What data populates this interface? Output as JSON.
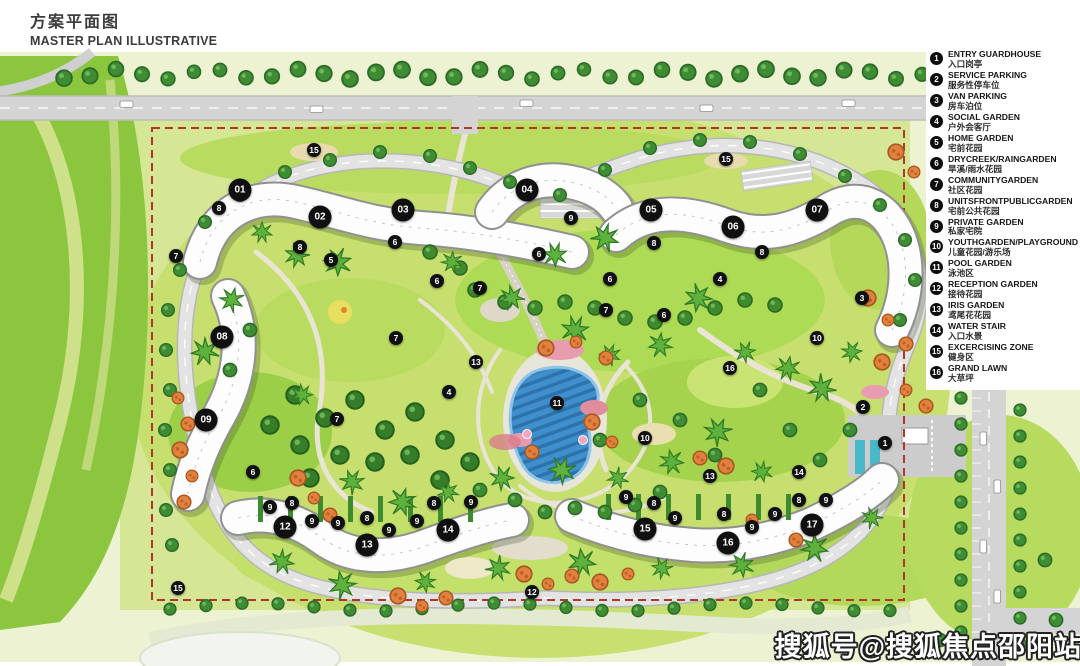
{
  "title": {
    "cn": "方案平面图",
    "en": "MASTER PLAN ILLUSTRATIVE"
  },
  "watermark": {
    "text": "搜狐号@搜狐焦点邵阳站"
  },
  "colors": {
    "boundary_red": "#b0362b",
    "marker_black": "#101010",
    "pool_blue": "#3f8fcc",
    "lawn_green": "#c8e070",
    "dark_tree_green": "#3e8c34",
    "orange_tree": "#e0813f",
    "road_gray": "#d4d4d4"
  },
  "legend": {
    "items": [
      {
        "num": "1",
        "en": "ENTRY GUARDHOUSE",
        "cn": "入口岗亭"
      },
      {
        "num": "2",
        "en": "SERVICE PARKING",
        "cn": "服务性停车位"
      },
      {
        "num": "3",
        "en": "VAN PARKING",
        "cn": "房车泊位"
      },
      {
        "num": "4",
        "en": "SOCIAL GARDEN",
        "cn": "户外会客厅"
      },
      {
        "num": "5",
        "en": "HOME GARDEN",
        "cn": "宅前花园"
      },
      {
        "num": "6",
        "en": "DRYCREEK/RAINGARDEN",
        "cn": "旱溪/雨水花园"
      },
      {
        "num": "7",
        "en": "COMMUNITYGARDEN",
        "cn": "社区花园"
      },
      {
        "num": "8",
        "en": "UNITSFRONTPUBLICGARDEN",
        "cn": "宅前公共花园"
      },
      {
        "num": "9",
        "en": "PRIVATE GARDEN",
        "cn": "私家宅院"
      },
      {
        "num": "10",
        "en": "YOUTHGARDEN/PLAYGROUND",
        "cn": "儿童花园/游乐场"
      },
      {
        "num": "11",
        "en": "POOL GARDEN",
        "cn": "泳池区"
      },
      {
        "num": "12",
        "en": "RECEPTION GARDEN",
        "cn": "接待花园"
      },
      {
        "num": "13",
        "en": "IRIS GARDEN",
        "cn": "鸢尾花花园"
      },
      {
        "num": "14",
        "en": "WATER STAIR",
        "cn": "入口水景"
      },
      {
        "num": "15",
        "en": "EXCERCISING ZONE",
        "cn": "健身区"
      },
      {
        "num": "16",
        "en": "GRAND LAWN",
        "cn": "大草坪"
      }
    ]
  },
  "buildings": [
    {
      "label": "01",
      "x": 240,
      "y": 190
    },
    {
      "label": "02",
      "x": 320,
      "y": 217
    },
    {
      "label": "03",
      "x": 403,
      "y": 210
    },
    {
      "label": "04",
      "x": 527,
      "y": 190
    },
    {
      "label": "05",
      "x": 651,
      "y": 210
    },
    {
      "label": "06",
      "x": 733,
      "y": 227
    },
    {
      "label": "07",
      "x": 817,
      "y": 210
    },
    {
      "label": "08",
      "x": 222,
      "y": 337
    },
    {
      "label": "09",
      "x": 206,
      "y": 420
    },
    {
      "label": "12",
      "x": 285,
      "y": 527
    },
    {
      "label": "13",
      "x": 367,
      "y": 545
    },
    {
      "label": "14",
      "x": 448,
      "y": 530
    },
    {
      "label": "15",
      "x": 645,
      "y": 529
    },
    {
      "label": "16",
      "x": 728,
      "y": 543
    },
    {
      "label": "17",
      "x": 812,
      "y": 525
    }
  ],
  "site_markers": [
    {
      "num": "15",
      "x": 314,
      "y": 150
    },
    {
      "num": "8",
      "x": 219,
      "y": 208
    },
    {
      "num": "7",
      "x": 176,
      "y": 256
    },
    {
      "num": "8",
      "x": 300,
      "y": 247
    },
    {
      "num": "5",
      "x": 331,
      "y": 260
    },
    {
      "num": "6",
      "x": 395,
      "y": 242
    },
    {
      "num": "6",
      "x": 437,
      "y": 281
    },
    {
      "num": "7",
      "x": 480,
      "y": 288
    },
    {
      "num": "15",
      "x": 726,
      "y": 159
    },
    {
      "num": "9",
      "x": 571,
      "y": 218
    },
    {
      "num": "6",
      "x": 539,
      "y": 254
    },
    {
      "num": "8",
      "x": 654,
      "y": 243
    },
    {
      "num": "8",
      "x": 762,
      "y": 252
    },
    {
      "num": "6",
      "x": 610,
      "y": 279
    },
    {
      "num": "4",
      "x": 720,
      "y": 279
    },
    {
      "num": "3",
      "x": 862,
      "y": 298
    },
    {
      "num": "7",
      "x": 606,
      "y": 310
    },
    {
      "num": "6",
      "x": 664,
      "y": 315
    },
    {
      "num": "10",
      "x": 817,
      "y": 338
    },
    {
      "num": "7",
      "x": 396,
      "y": 338
    },
    {
      "num": "13",
      "x": 476,
      "y": 362
    },
    {
      "num": "4",
      "x": 449,
      "y": 392
    },
    {
      "num": "7",
      "x": 337,
      "y": 419
    },
    {
      "num": "6",
      "x": 253,
      "y": 472
    },
    {
      "num": "11",
      "x": 557,
      "y": 403
    },
    {
      "num": "10",
      "x": 645,
      "y": 438
    },
    {
      "num": "16",
      "x": 730,
      "y": 368
    },
    {
      "num": "13",
      "x": 710,
      "y": 476
    },
    {
      "num": "14",
      "x": 799,
      "y": 472
    },
    {
      "num": "1",
      "x": 885,
      "y": 443
    },
    {
      "num": "2",
      "x": 863,
      "y": 407
    },
    {
      "num": "12",
      "x": 532,
      "y": 592
    },
    {
      "num": "15",
      "x": 178,
      "y": 588
    },
    {
      "num": "9",
      "x": 270,
      "y": 507
    },
    {
      "num": "8",
      "x": 292,
      "y": 503
    },
    {
      "num": "9",
      "x": 312,
      "y": 521
    },
    {
      "num": "9",
      "x": 338,
      "y": 523
    },
    {
      "num": "8",
      "x": 367,
      "y": 518
    },
    {
      "num": "9",
      "x": 389,
      "y": 530
    },
    {
      "num": "9",
      "x": 417,
      "y": 521
    },
    {
      "num": "8",
      "x": 434,
      "y": 503
    },
    {
      "num": "9",
      "x": 471,
      "y": 502
    },
    {
      "num": "9",
      "x": 626,
      "y": 497
    },
    {
      "num": "8",
      "x": 654,
      "y": 503
    },
    {
      "num": "9",
      "x": 675,
      "y": 518
    },
    {
      "num": "8",
      "x": 724,
      "y": 514
    },
    {
      "num": "9",
      "x": 752,
      "y": 527
    },
    {
      "num": "9",
      "x": 775,
      "y": 514
    },
    {
      "num": "8",
      "x": 799,
      "y": 500
    },
    {
      "num": "9",
      "x": 826,
      "y": 500
    }
  ]
}
